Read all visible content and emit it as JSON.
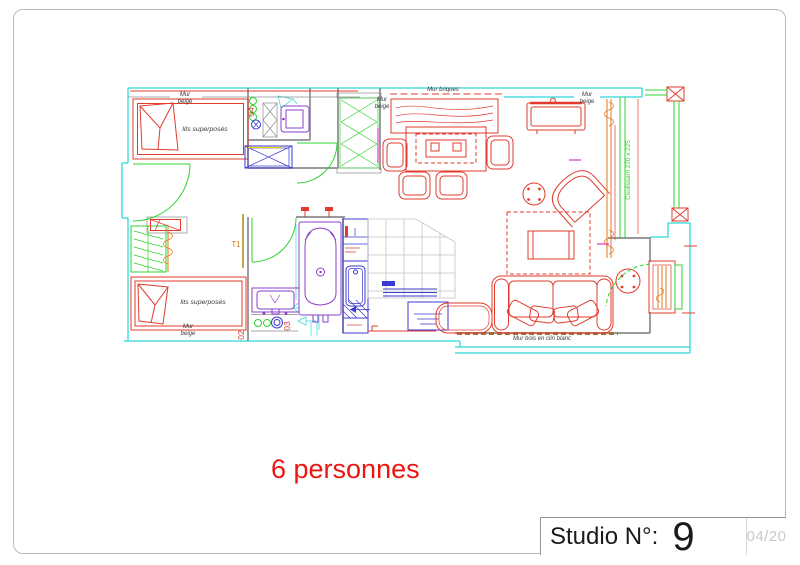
{
  "colors": {
    "wall_exterior": "#2fd8d8",
    "wall_interior": "#8c8c8c",
    "furniture_red": "#e23b2e",
    "door_green": "#2fd32f",
    "fixture_purple": "#8a3fc9",
    "kitchen_blue": "#3a3ad2",
    "curtain_orange": "#e0771e",
    "accent_yellow": "#e8d800",
    "accent_magenta": "#e040c0",
    "wood_brown": "#b06a28",
    "tile_gray": "#c4c4c4",
    "olive": "#a08200",
    "label_dark": "#3a3a3a",
    "text_red": "#ee1511",
    "title_dark": "#1a1a1a",
    "muted_gray": "#c6cacd",
    "border_gray": "#b8bcc0"
  },
  "page": {
    "capacity_note": "6 personnes",
    "title_block": {
      "studio_label": "Studio N°:",
      "studio_number": "9",
      "page_ref": "04/20"
    }
  },
  "plan": {
    "labels": {
      "mur_line1": "Mur",
      "mur_line2": "beige",
      "mur_briques": "Mur briques",
      "mur_bois": "Mur bois en clin blanc",
      "lits_superposes": "lits superposés",
      "coulissant": "Coulissant 220 x 225",
      "unit_type": "T1",
      "ref_02": "02",
      "ref_03": "03",
      "ref_04": "04"
    }
  }
}
